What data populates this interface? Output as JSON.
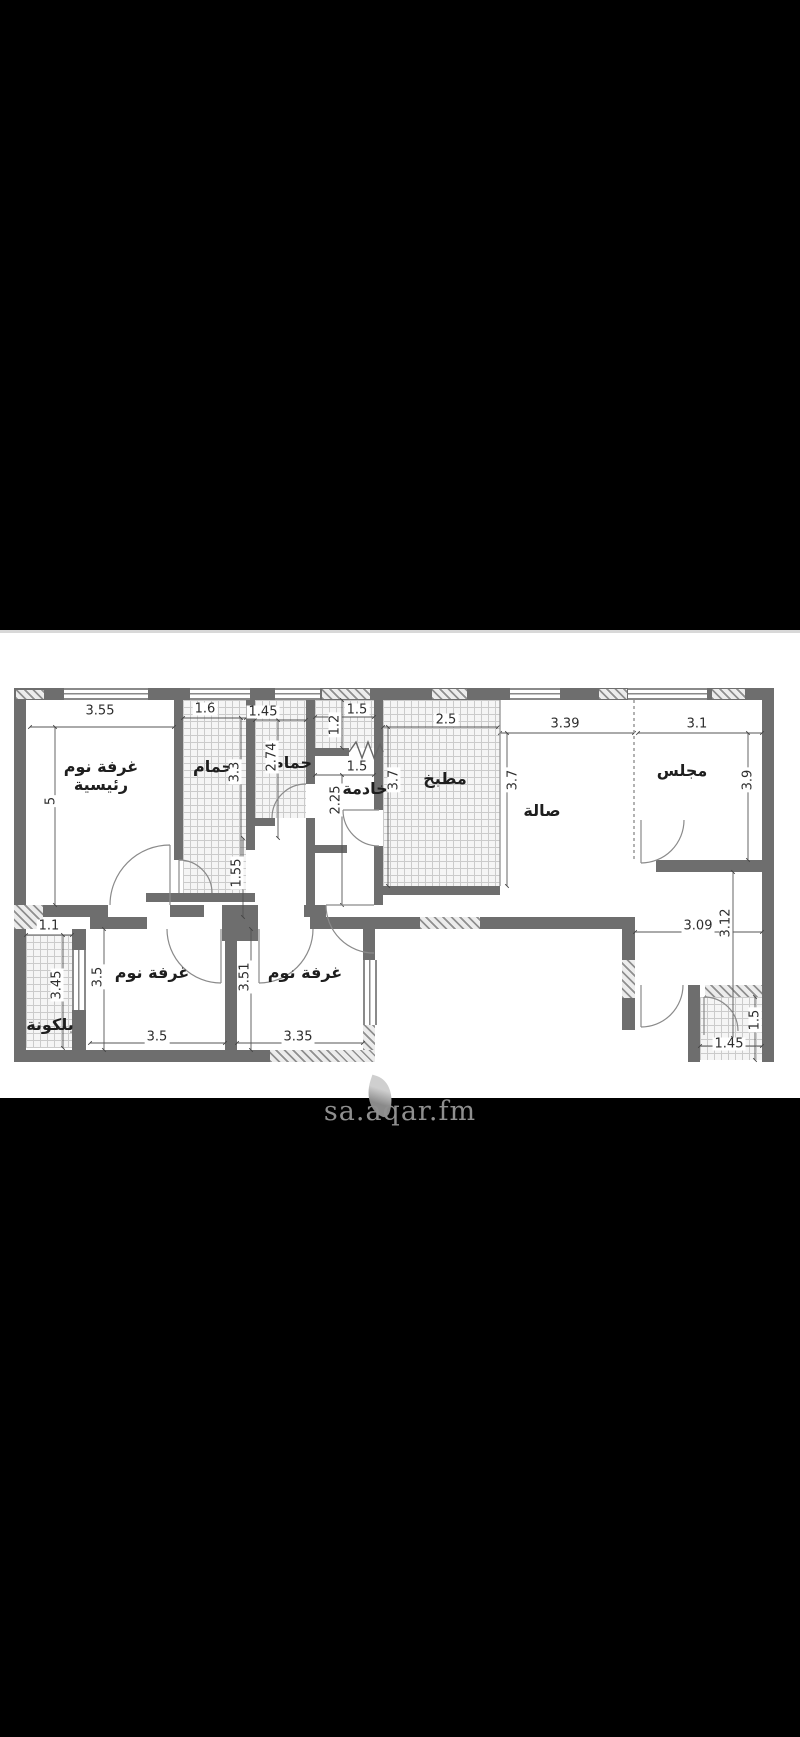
{
  "screen": {
    "background": "#000000",
    "panel_background": "#ffffff"
  },
  "floor_plan": {
    "wall_color": "#6e6e6e",
    "rooms": [
      {
        "name": "master-bedroom",
        "label": "غرفة نوم رئيسية"
      },
      {
        "name": "bathroom-1",
        "label": "حمام"
      },
      {
        "name": "bathroom-2",
        "label": "حمام"
      },
      {
        "name": "maid-room",
        "label": "خادمة"
      },
      {
        "name": "kitchen",
        "label": "مطبخ"
      },
      {
        "name": "hall",
        "label": "صالة"
      },
      {
        "name": "majlis",
        "label": "مجلس"
      },
      {
        "name": "bedroom-1",
        "label": "غرفة نوم"
      },
      {
        "name": "bedroom-2",
        "label": "غرفة نوم"
      },
      {
        "name": "balcony",
        "label": "بلكونة"
      }
    ],
    "dimensions": [
      {
        "v": "3.55"
      },
      {
        "v": "1.6"
      },
      {
        "v": "1.45"
      },
      {
        "v": "1.5"
      },
      {
        "v": "1.2"
      },
      {
        "v": "2.5"
      },
      {
        "v": "3.39"
      },
      {
        "v": "3.1"
      },
      {
        "v": "5"
      },
      {
        "v": "3.3"
      },
      {
        "v": "2.74"
      },
      {
        "v": "1.5"
      },
      {
        "v": "2.25"
      },
      {
        "v": "3.7"
      },
      {
        "v": "3.7"
      },
      {
        "v": "3.9"
      },
      {
        "v": "1.55"
      },
      {
        "v": "1.1"
      },
      {
        "v": "3.45"
      },
      {
        "v": "3.5"
      },
      {
        "v": "3.51"
      },
      {
        "v": "3.09"
      },
      {
        "v": "3.12"
      },
      {
        "v": "3.5"
      },
      {
        "v": "3.35"
      },
      {
        "v": "1.45"
      },
      {
        "v": "1.5"
      }
    ]
  },
  "watermark": {
    "text": "sa.aqar.fm",
    "color": "#8f8f8f"
  }
}
